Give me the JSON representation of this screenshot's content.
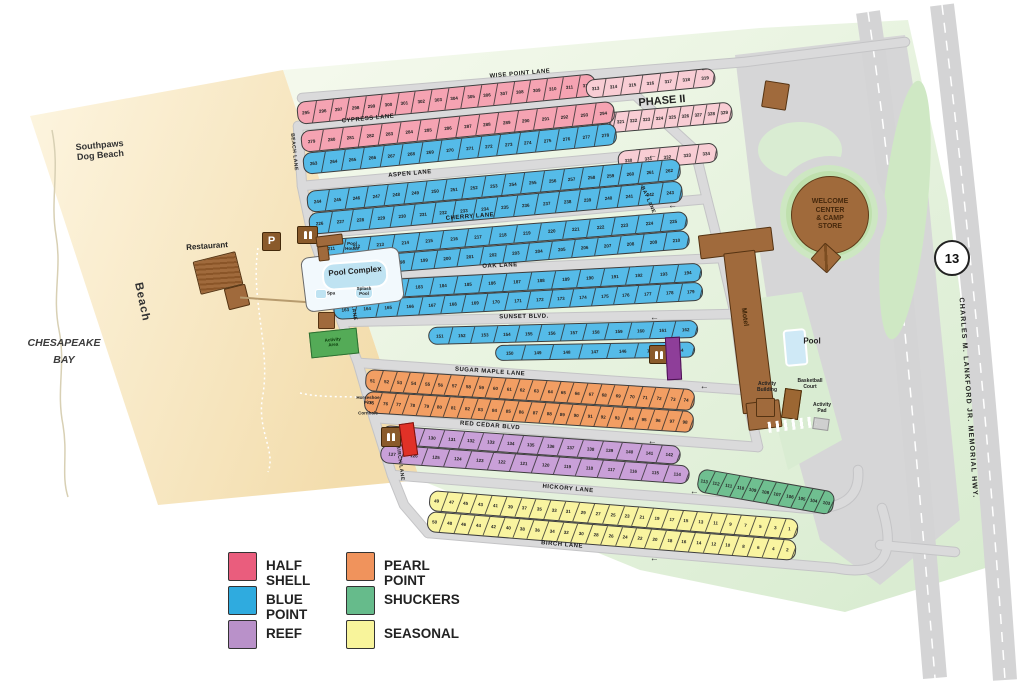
{
  "sections": [
    {
      "id": "half_shell",
      "label": "HALF SHELL",
      "legend_color": "#EA5D7D",
      "fill": "#F5A3B2"
    },
    {
      "id": "blue_point",
      "label": "BLUE POINT",
      "legend_color": "#2FABDF",
      "fill": "#55BBE8"
    },
    {
      "id": "reef",
      "label": "REEF",
      "legend_color": "#B991C9",
      "fill": "#C9A0D8"
    },
    {
      "id": "pearl_point",
      "label": "PEARL POINT",
      "legend_color": "#F0935C",
      "fill": "#F29E63"
    },
    {
      "id": "shuckers",
      "label": "SHUCKERS",
      "legend_color": "#66BB8B",
      "fill": "#6FBF90"
    },
    {
      "id": "seasonal",
      "label": "SEASONAL",
      "legend_color": "#F8F49B",
      "fill": "#F9F4A0"
    },
    {
      "id": "phase2",
      "label": "PHASE II",
      "legend_color": null,
      "fill": "#F8CDD4"
    }
  ],
  "lanes": {
    "wise_point": "WISE POINT LANE",
    "cypress": "CYPRESS LANE",
    "aspen": "ASPEN LANE",
    "cherry": "CHERRY LANE",
    "oak": "OAK LANE",
    "sunset": "SUNSET BLVD.",
    "sugar_maple": "SUGAR MAPLE LANE",
    "red_cedar": "RED CEDAR BLVD",
    "hickory": "HICKORY LANE",
    "birch": "BIRCH LANE",
    "beach_lane": "BEACH LANE",
    "bay_lane": "BAY LANE"
  },
  "site_rows": {
    "A": {
      "from": 295,
      "to": 312
    },
    "P2R1": {
      "from": 313,
      "to": 319
    },
    "P2R2": {
      "from": 320,
      "to": 329
    },
    "P2R3": {
      "from": 330,
      "to": 334
    },
    "B": {
      "from": 279,
      "to": 294
    },
    "C": {
      "from": 263,
      "to": 278
    },
    "D": {
      "from": 244,
      "to": 262
    },
    "E": {
      "from": 226,
      "to": 243
    },
    "F": {
      "from": 211,
      "to": 225
    },
    "G": {
      "from": 195,
      "to": 210
    },
    "H": {
      "from": 180,
      "to": 194
    },
    "I": {
      "from": 163,
      "to": 179
    },
    "J": {
      "from": 151,
      "to": 162
    },
    "J2": {
      "from": 150,
      "to": 144
    },
    "K": {
      "from": 51,
      "to": 74
    },
    "L": {
      "from": 75,
      "to": 98
    },
    "M": {
      "from": 128,
      "to": 142
    },
    "N": {
      "from": 127,
      "to": 114
    },
    "GR": {
      "from": 113,
      "to": 103
    },
    "O": {
      "from": 49,
      "to": 1,
      "step": -2
    },
    "P": {
      "from": 50,
      "to": 2,
      "step": -2
    }
  },
  "pois": {
    "restaurant": "Restaurant",
    "parking": "P",
    "pool_house": "Pool\nHouse",
    "pool_complex": "Pool Complex",
    "splash_pool": "Splash\nPool",
    "spa": "Spa",
    "activity_area": "Activity\nArea",
    "horseshoe_pits": "Horseshoe\nPits",
    "cornhole": "Cornhole",
    "welcome_center": "WELCOME\nCENTER\n& CAMP\nSTORE",
    "motel": "Motel",
    "pool": "Pool",
    "activity_building": "Activity\nBuilding",
    "basketball_court": "Basketball\nCourt",
    "activity_pad": "Activity\nPad",
    "phase_2": "PHASE II",
    "route_13": "13",
    "highway": "CHARLES M. LANKFORD JR. MEMORIAL HWY.",
    "chesapeake_bay": "CHESAPEAKE\nBAY",
    "beach": "Beach",
    "dog_beach": "Southpaws\nDog Beach"
  },
  "icons": {
    "arrow_left": "←"
  }
}
